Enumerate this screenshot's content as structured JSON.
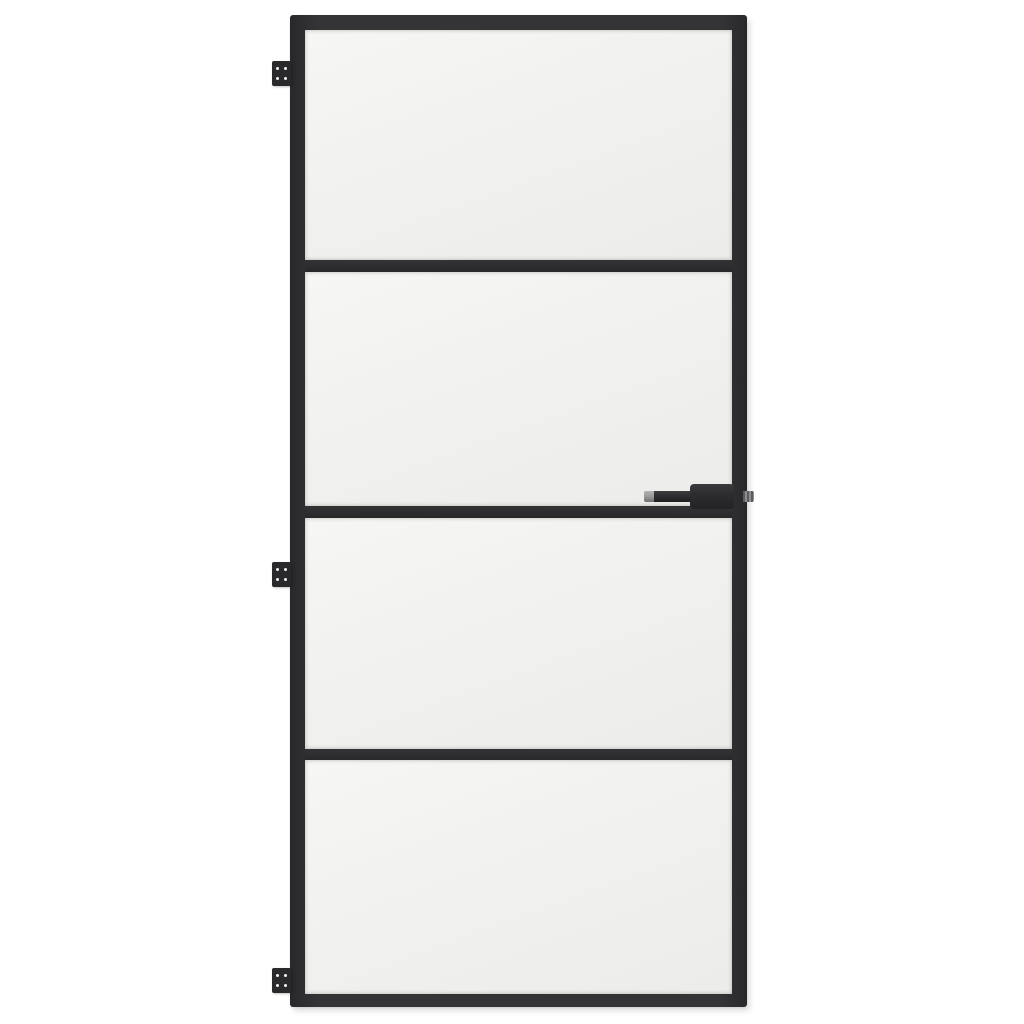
{
  "scene": {
    "type": "product-photo",
    "subject": "Interior door with slim black aluminium frame and frosted tempered glass, on plain white background",
    "orientation": "hinges on left, handle on right"
  },
  "door": {
    "panel_count": 4,
    "muntin_count": 3,
    "glass_finish": "frosted",
    "hinges": [
      {
        "id": "hinge-top",
        "screws": 4
      },
      {
        "id": "hinge-middle",
        "screws": 4
      },
      {
        "id": "hinge-bottom",
        "screws": 4
      }
    ],
    "handle": {
      "side": "right",
      "style": "lever",
      "lever_direction": "left",
      "has_spindle_nub": true,
      "tip_finish": "grey"
    }
  },
  "colors": {
    "background": "#ffffff",
    "frame": "#343436",
    "frame-dark": "#28282a",
    "glass": "#f0f0ee",
    "glass-light": "#f6f6f4",
    "hinge": "#29292b",
    "screw": "#f2f2f2",
    "handle": "#2d2d2f",
    "handle-tip": "#9a9a9a",
    "spindle": "#8e8e90"
  }
}
